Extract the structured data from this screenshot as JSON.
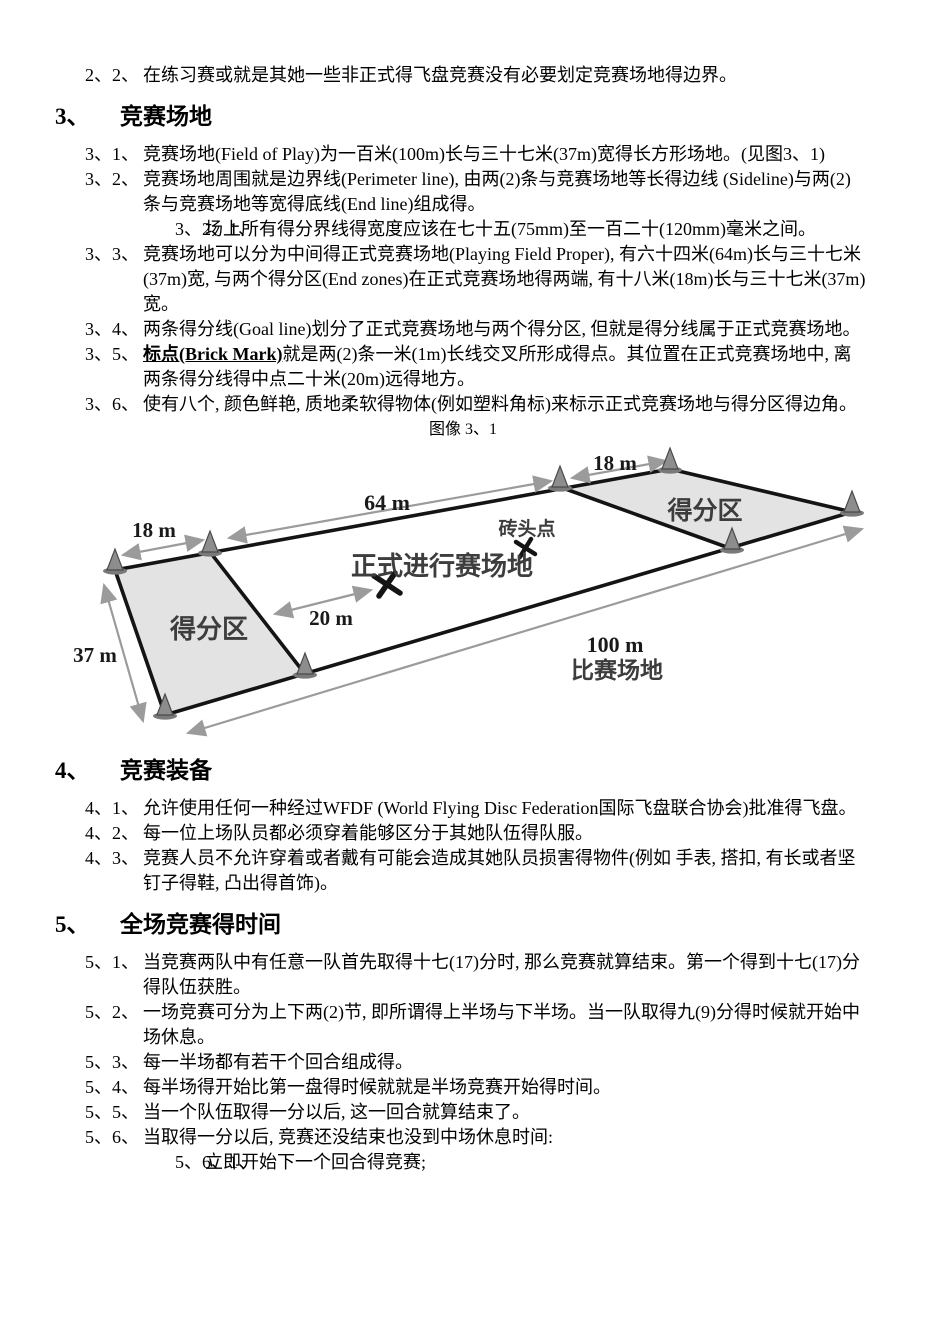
{
  "colors": {
    "text": "#000000",
    "background": "#ffffff",
    "diagram_line": "#141414",
    "diagram_arrow": "#9b9b9b",
    "endzone_fill": "#e3e3e3",
    "cone_fill": "#8d8d8d"
  },
  "intro": {
    "num": "2、2、",
    "text": "在练习赛或就是其她一些非正式得飞盘竞赛没有必要划定竞赛场地得边界。"
  },
  "section3": {
    "num": "3、",
    "title": "竞赛场地",
    "items": [
      {
        "num": "3、1、",
        "text": "竞赛场地(Field of Play)为一百米(100m)长与三十七米(37m)宽得长方形场地。(见图3、1)"
      },
      {
        "num": "3、2、",
        "text": "竞赛场地周围就是边界线(Perimeter line), 由两(2)条与竞赛场地等长得边线 (Sideline)与两(2)条与竞赛场地等宽得底线(End line)组成得。"
      },
      {
        "num": "3、2、1、",
        "text": "场上所有得分界线得宽度应该在七十五(75mm)至一百二十(120mm)毫米之间。"
      },
      {
        "num": "3、3、",
        "text": "竞赛场地可以分为中间得正式竞赛场地(Playing Field Proper), 有六十四米(64m)长与三十七米(37m)宽, 与两个得分区(End zones)在正式竞赛场地得两端, 有十八米(18m)长与三十七米(37m)宽。"
      },
      {
        "num": "3、4、",
        "text": "两条得分线(Goal line)划分了正式竞赛场地与两个得分区, 但就是得分线属于正式竞赛场地。"
      },
      {
        "num": "3、5、",
        "lead": "标点(Brick Mark)",
        "text": "就是两(2)条一米(1m)长线交叉所形成得点。其位置在正式竞赛场地中, 离两条得分线得中点二十米(20m)远得地方。"
      },
      {
        "num": "3、6、",
        "text": "使有八个, 颜色鲜艳, 质地柔软得物体(例如塑料角标)来标示正式竞赛场地与得分区得边角。"
      }
    ]
  },
  "figure": {
    "caption": "图像 3、1",
    "labels": {
      "dim_18m_left": "18 m",
      "dim_64m": "64 m",
      "dim_18m_right": "18 m",
      "dim_37m": "37 m",
      "dim_20m": "20 m",
      "dim_100m": "100 m",
      "field_name": "比赛场地",
      "brick_point": "砖头点",
      "playing_field": "正式进行赛场地",
      "endzone_left": "得分区",
      "endzone_right": "得分区"
    }
  },
  "section4": {
    "num": "4、",
    "title": "竞赛装备",
    "items": [
      {
        "num": "4、1、",
        "text": "允许使用任何一种经过WFDF (World Flying Disc Federation国际飞盘联合协会)批准得飞盘。"
      },
      {
        "num": "4、2、",
        "text": "每一位上场队员都必须穿着能够区分于其她队伍得队服。"
      },
      {
        "num": "4、3、",
        "text": "竞赛人员不允许穿着或者戴有可能会造成其她队员损害得物件(例如 手表, 搭扣, 有长或者坚钉子得鞋, 凸出得首饰)。"
      }
    ]
  },
  "section5": {
    "num": "5、",
    "title": "全场竞赛得时间",
    "items": [
      {
        "num": "5、1、",
        "text": "当竞赛两队中有任意一队首先取得十七(17)分时, 那么竞赛就算结束。第一个得到十七(17)分得队伍获胜。"
      },
      {
        "num": "5、2、",
        "text": "一场竞赛可分为上下两(2)节, 即所谓得上半场与下半场。当一队取得九(9)分得时候就开始中场休息。"
      },
      {
        "num": "5、3、",
        "text": "每一半场都有若干个回合组成得。"
      },
      {
        "num": "5、4、",
        "text": "每半场得开始比第一盘得时候就就是半场竞赛开始得时间。"
      },
      {
        "num": "5、5、",
        "text": "当一个队伍取得一分以后, 这一回合就算结束了。"
      },
      {
        "num": "5、6、",
        "text": "当取得一分以后, 竞赛还没结束也没到中场休息时间:"
      },
      {
        "num": "5、6、1、",
        "text": "立即开始下一个回合得竞赛;"
      }
    ]
  }
}
